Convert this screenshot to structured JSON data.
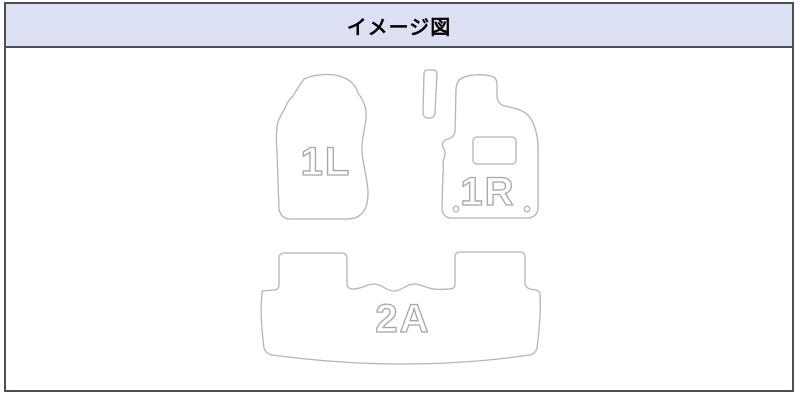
{
  "header": {
    "title": "イメージ図"
  },
  "diagram": {
    "description": "car-floor-mat-set-outline-drawing",
    "mats": [
      {
        "id": "front-left-mat",
        "label": "1L"
      },
      {
        "id": "front-right-mat",
        "label": "1R"
      },
      {
        "id": "rear-mat",
        "label": "2A"
      }
    ],
    "front_right_details": [
      "heel-pad-rectangle",
      "two-fixing-grommets"
    ],
    "extra_pieces": [
      "accelerator-side-small-pad"
    ]
  },
  "colors": {
    "header_background": "#dbe0f2",
    "frame_border": "#4a4e57",
    "mat_outline": "#b4b4b4",
    "label_outline": "#a6a6a6",
    "page_background": "#ffffff"
  }
}
